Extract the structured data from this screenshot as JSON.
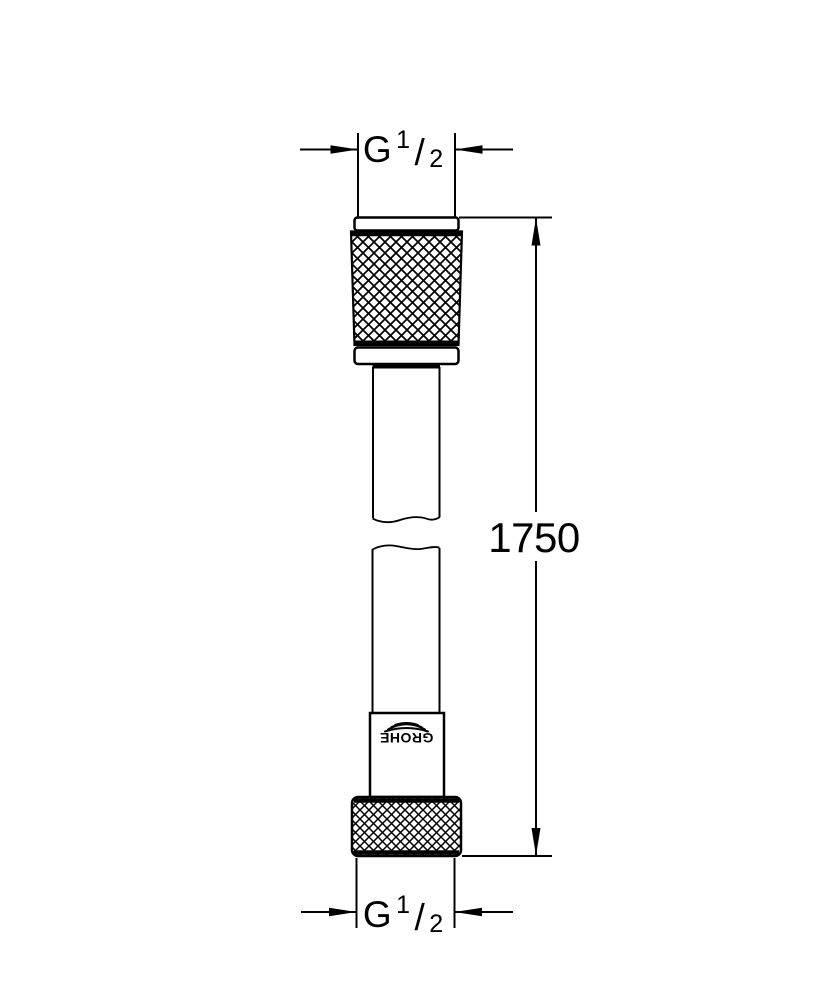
{
  "colors": {
    "line": "#000000",
    "background": "#ffffff"
  },
  "drawing": {
    "brand": "GROHE",
    "dimensions": {
      "top_thread": {
        "g": "G",
        "numerator": "1",
        "slash": "/",
        "denominator": "2"
      },
      "length": {
        "value": "1750"
      },
      "bottom_thread": {
        "g": "G",
        "numerator": "1",
        "slash": "/",
        "denominator": "2"
      }
    }
  }
}
